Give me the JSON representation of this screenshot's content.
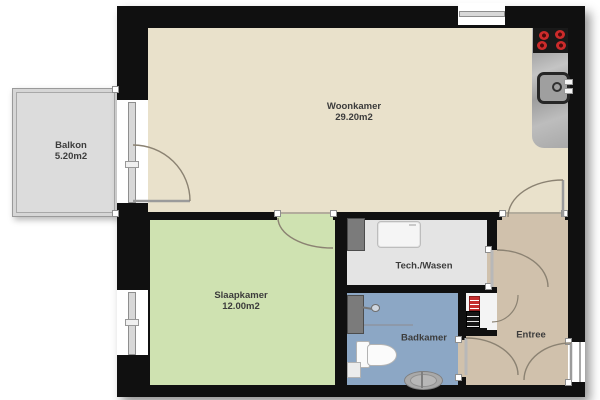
{
  "rooms": {
    "balkon": {
      "label": "Balkon",
      "area": "5.20m2"
    },
    "woonkamer": {
      "label": "Woonkamer",
      "area": "29.20m2"
    },
    "slaapkamer": {
      "label": "Slaapkamer",
      "area": "12.00m2"
    },
    "tech": {
      "label": "Tech./Wasen"
    },
    "badkamer": {
      "label": "Badkamer"
    },
    "entree": {
      "label": "Entree"
    }
  },
  "colors": {
    "wall": "#101010",
    "woonkamer_floor": "#e9e1cb",
    "slaapkamer_floor": "#cfe2b1",
    "badkamer_floor": "#8ca7c5",
    "entree_floor": "#d0c1ac",
    "tech_floor": "#e4e4e4",
    "balkon_floor": "#dcdcdc",
    "stove_burner": "#cc2b2b",
    "door_arc": "#8b8272"
  },
  "fixtures": {
    "kitchen": [
      "stove-icon",
      "sink-icon",
      "kitchen-counter"
    ],
    "tech": [
      "washing-machine-icon",
      "cabinet"
    ],
    "badkamer": [
      "toilet-icon",
      "washbasin-icon",
      "shower-head-icon",
      "bath-sink-icon"
    ],
    "meterkast": [
      "red-meter-unit-icon",
      "electrical-panel-icon"
    ]
  }
}
